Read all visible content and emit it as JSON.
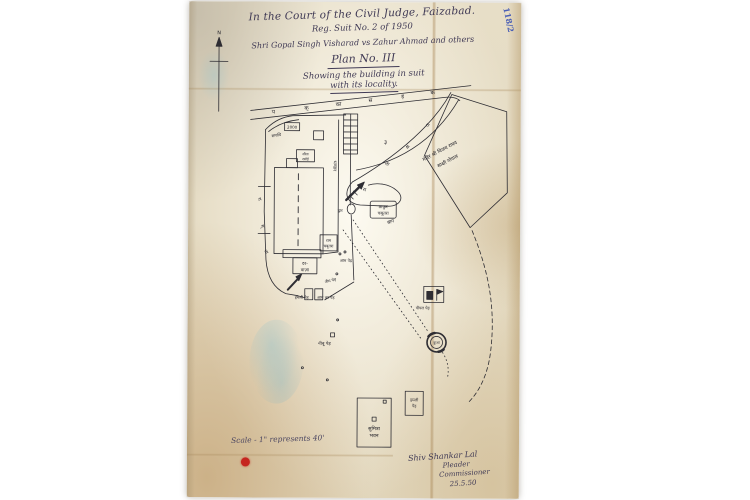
{
  "header": {
    "court": "In the Court of the Civil Judge, Faizabad.",
    "suit": "Reg. Suit No. 2 of 1950",
    "parties": "Shri Gopal Singh Visharad  vs  Zahur Ahmad and others",
    "plan_no": "Plan No. III",
    "subtitle1": "Showing the building in suit",
    "subtitle2": "with its locality.",
    "corner_mark": "118/2"
  },
  "compass": {
    "north": "N"
  },
  "road": {
    "letters": [
      "प",
      "क्",
      "का",
      "स",
      "ड़",
      "क"
    ]
  },
  "paths": {
    "band_letters": [
      "रा",
      "स",
      "ता",
      "रा"
    ],
    "wall_letters": [
      "रा",
      "स्",
      "ता"
    ]
  },
  "labels": {
    "samadhi": "समाधि",
    "plot_no": "2000",
    "sita_rasoi_1": "सीता",
    "sita_rasoi_2": "रसोई",
    "bhandar": "भण्डार",
    "darwaza_1": "दर-",
    "darwaza_2": "वाज़ा",
    "ram_chabutra_1": "राम",
    "ram_chabutra_2": "चबूतरा",
    "aam_ped": "आम पेड़",
    "neem_ped": "नीम पेड़",
    "imli_gate": "इमली पेड़",
    "aam_gate": "आम का पेड़",
    "thakur_1": "ठाकुर",
    "thakur_2": "चबूतरा",
    "dwar": "द्वार",
    "open_no": "३",
    "bagh": "बाग",
    "temple_1": "मंदिर श्री विजय राघव",
    "temple_2": "साक्षी गोपाल",
    "pipal_ped": "पीपल पेड़",
    "kuan": "कुआं",
    "nibu_ped": "नीबू पेड़",
    "sumitra_1": "सुमित्रा",
    "sumitra_2": "भवन",
    "imli_right_1": "इमली",
    "imli_right_2": "पेड़"
  },
  "footer": {
    "scale": "Scale - 1\" represents 40'",
    "sig_name": "Shiv Shankar Lal",
    "sig_role1": "Pleader",
    "sig_role2": "Commissioner",
    "sig_date": "25.5.50"
  },
  "colors": {
    "paper": "#e7dec7",
    "ink": "#2e2d33",
    "header_ink": "#403a55",
    "crease": "#c9b893",
    "blue_note": "#4a5fb5",
    "red_dot": "#c5251f",
    "smudge": "#b9d6da"
  }
}
